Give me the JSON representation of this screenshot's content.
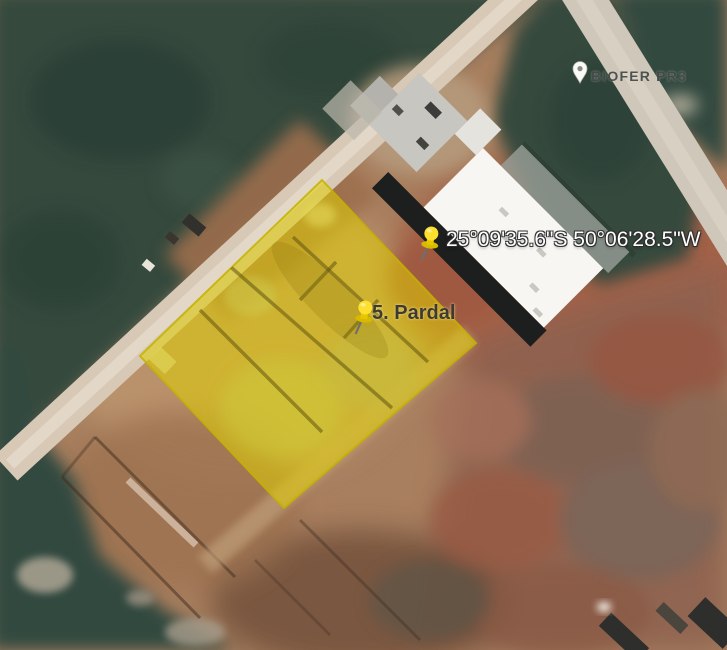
{
  "placemarks": [
    {
      "id": "coordinate-placemark",
      "label": "25°09'35.6\"S 50°06'28.5\"W",
      "icon": "yellow-pushpin"
    },
    {
      "id": "pardal-placemark",
      "label": "5. Pardal",
      "icon": "yellow-pushpin"
    },
    {
      "id": "biofer-placemark",
      "label": "BIOFER PR3",
      "icon": "white-map-pin"
    }
  ],
  "overlay_polygon": {
    "name": "highlighted-lot",
    "fill_color": "#DCCB02",
    "fill_opacity": 0.55,
    "stroke_color": "#C4B200"
  },
  "colors": {
    "forest": "#34493E",
    "road": "#D8C9B6",
    "dirt": "#A87F5F",
    "red_field": "#985F49",
    "building_roof": "#F7F6F2",
    "building_dark_roof": "#1D1F1E",
    "pushpin_yellow": "#FFDF2E"
  }
}
